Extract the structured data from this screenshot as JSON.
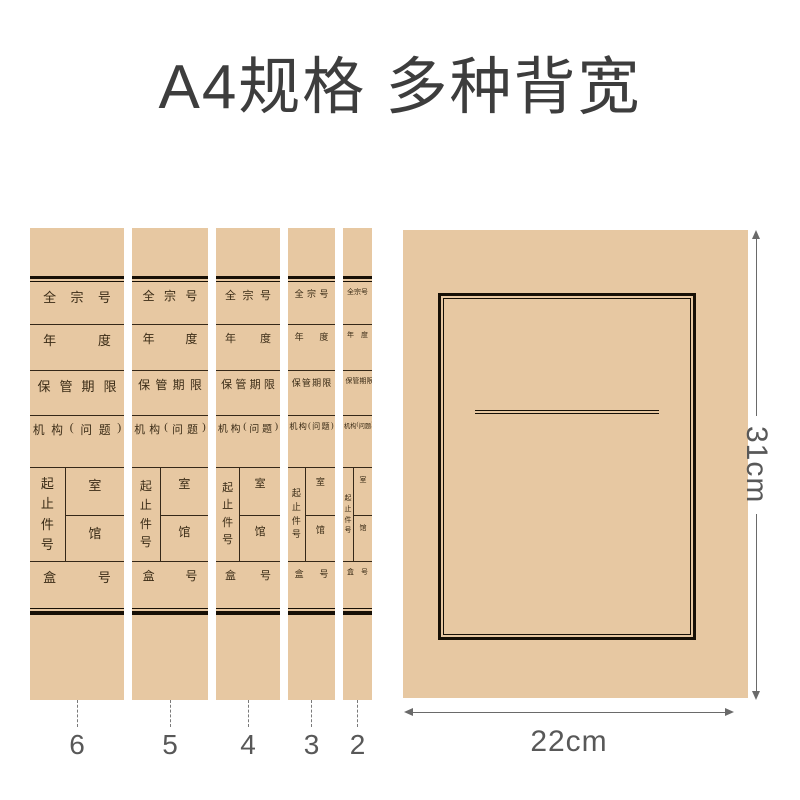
{
  "title": "A4规格 多种背宽",
  "spine_labels": {
    "quanzonghao": "全宗号",
    "niandu": "年度",
    "baoguanqixian": "保管期限",
    "jigou": "机构(问题)",
    "qizhijianhao": "起止件号",
    "shi": "室",
    "guan": "馆",
    "hehao": "盒号"
  },
  "spines": [
    {
      "size_label": "6",
      "width_cm": 6,
      "width_px": 94,
      "font_px": 13
    },
    {
      "size_label": "5",
      "width_cm": 5,
      "width_px": 76,
      "font_px": 12
    },
    {
      "size_label": "4",
      "width_cm": 4,
      "width_px": 64,
      "font_px": 11
    },
    {
      "size_label": "3",
      "width_cm": 3,
      "width_px": 47,
      "font_px": 9
    },
    {
      "size_label": "2",
      "width_cm": 2,
      "width_px": 29,
      "font_px": 7
    }
  ],
  "cover": {
    "height_label": "31cm",
    "width_label": "22cm"
  },
  "colors": {
    "kraft": "#e7c8a2",
    "rule": "#171006",
    "cell_line": "#352818",
    "spine_text": "#3a2b16",
    "title_color": "#3d3d3d",
    "dim_color": "#585858",
    "arrow_color": "#6a6a6a"
  }
}
